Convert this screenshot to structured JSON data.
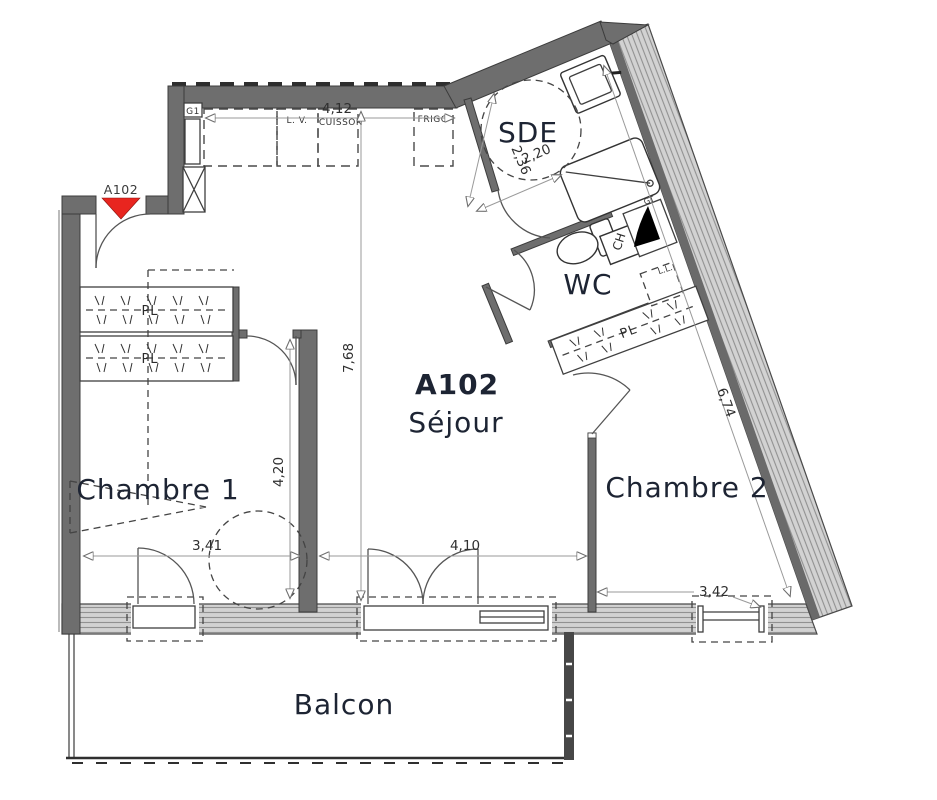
{
  "labels": {
    "entrance": "A102",
    "sejour_code": "A102",
    "sejour": "Séjour",
    "chambre1": "Chambre 1",
    "chambre2": "Chambre 2",
    "sde": "SDE",
    "wc": "WC",
    "balcon": "Balcon"
  },
  "annotations": {
    "g1": "G1",
    "gt": "GT",
    "ch": "CH",
    "ll": "L.L.",
    "lv": "L. V.",
    "cuisson": "CUISSON",
    "frigo": "FRIGO",
    "pl": "PL"
  },
  "dimensions": {
    "kitchen_width": "4,12",
    "sde_width": "2,20",
    "sde_depth": "2,36",
    "sejour_height": "7,68",
    "chambre1_height": "4,20",
    "chambre1_width": "3,41",
    "sejour_width": "4,10",
    "chambre2_width": "3,42",
    "chambre2_depth": "6,74"
  },
  "colors": {
    "entrance_arrow": "#e8251f",
    "wall": "#6e6e6e",
    "label_ink": "#1d2433"
  }
}
